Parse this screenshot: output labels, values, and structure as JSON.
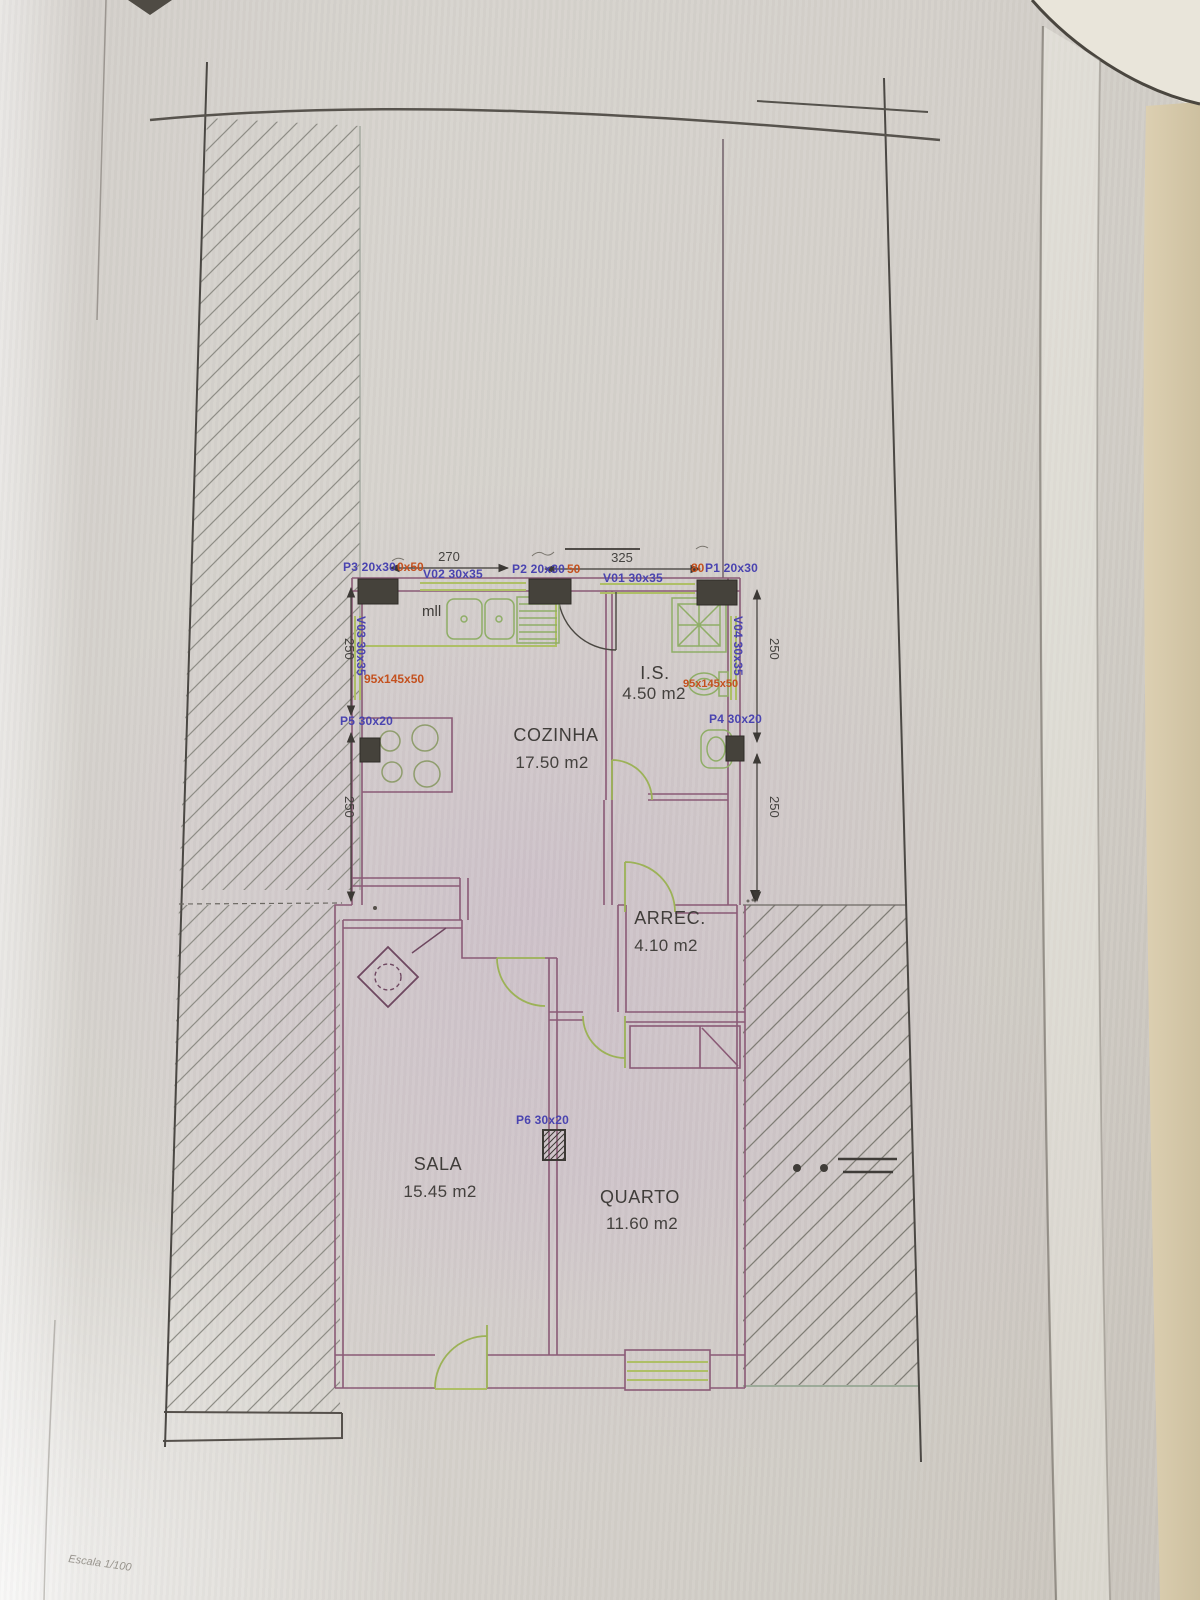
{
  "photo": {
    "scale_note": "Escala 1/100"
  },
  "rooms": {
    "cozinha": {
      "name": "COZINHA",
      "area": "17.50 m2"
    },
    "is": {
      "name": "I.S.",
      "area": "4.50 m2"
    },
    "arrec": {
      "name": "ARREC.",
      "area": "4.10 m2"
    },
    "sala": {
      "name": "SALA",
      "area": "15.45 m2"
    },
    "quarto": {
      "name": "QUARTO",
      "area": "11.60 m2"
    }
  },
  "openings": {
    "p1": {
      "label": "P1 20x30",
      "note": "80"
    },
    "p2": {
      "label": "P2 20x30",
      "note": "50"
    },
    "p3": {
      "label": "P3 20x30",
      "note": "0x50"
    },
    "p4": {
      "label": "P4 30x20"
    },
    "p5": {
      "label": "P5 30x20"
    },
    "p6": {
      "label": "P6 30x20"
    },
    "v01": {
      "label": "V01 30x35"
    },
    "v02": {
      "label": "V02 30x35"
    },
    "v03": {
      "label": "V03 30x35"
    },
    "v04": {
      "label": "V04 30x35"
    }
  },
  "annotations": {
    "window_note_left": "95x145x50",
    "window_note_right": "95x145x50",
    "kitchen_appliance": "mll"
  },
  "dimensions": {
    "top_left_wall": "270",
    "top_right_wall": "325",
    "left_upper": "250",
    "left_lower": "250",
    "right_upper": "250",
    "right_lower": "250"
  },
  "colors": {
    "paper": "#d5d1cb",
    "wall_line": "#8a5a76",
    "fixture_green": "#8fae67",
    "counter_olive": "#aebf66",
    "label_blue": "#4a44b0",
    "label_red": "#c4511f",
    "ink": "#45423e",
    "next_page": "#d6c9ab"
  }
}
